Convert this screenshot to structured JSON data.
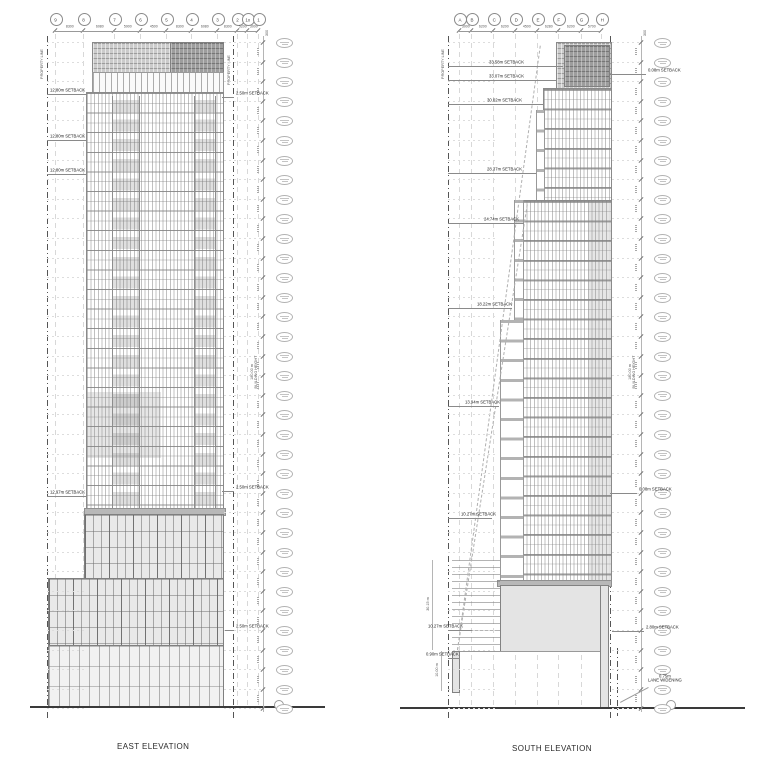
{
  "sheet": {
    "background": "#ffffff",
    "line_color": "#8a8a8a",
    "dark_panel_color": "#9d9d9d",
    "light_panel_color": "#cbcbcb"
  },
  "east": {
    "title": "EAST ELEVATION",
    "property_line_left": "PROPERTY LINE",
    "property_line_right": "PROPERTY LINE",
    "building_height_value": "180.00 m",
    "building_height_caption": "BUILDING HEIGHT",
    "top_margin_dim": "300",
    "level_column": {
      "count": 35
    },
    "grid_bubbles": [
      {
        "label": "9",
        "x": 55
      },
      {
        "label": "8",
        "x": 83
      },
      {
        "label": "7",
        "x": 114
      },
      {
        "label": "6",
        "x": 140
      },
      {
        "label": "5",
        "x": 166
      },
      {
        "label": "4",
        "x": 191
      },
      {
        "label": "3",
        "x": 217
      },
      {
        "label": "2",
        "x": 237
      },
      {
        "label": "1x",
        "x": 247
      },
      {
        "label": "1",
        "x": 258
      }
    ],
    "grid_dims": [
      "8300",
      "6080",
      "5900",
      "4500",
      "8300",
      "6080",
      "8300",
      "5200",
      "3000"
    ],
    "setbacks": [
      {
        "label": "12.80m SETBACK",
        "side": "left",
        "y": 90,
        "x1": 47,
        "x2": 86,
        "tx": 50
      },
      {
        "label": "12.80m SETBACK",
        "side": "left",
        "y": 136,
        "x1": 47,
        "x2": 86,
        "tx": 50
      },
      {
        "label": "12.80m SETBACK",
        "side": "left",
        "y": 170,
        "x1": 47,
        "x2": 86,
        "tx": 50
      },
      {
        "label": "12.97m SETBACK",
        "side": "left",
        "y": 492,
        "x1": 47,
        "x2": 86,
        "tx": 50
      },
      {
        "label": "2.50m SETBACK",
        "side": "right",
        "y": 93,
        "x1": 222,
        "x2": 234,
        "tx": 236
      },
      {
        "label": "2.50m SETBACK",
        "side": "right",
        "y": 487,
        "x1": 222,
        "x2": 234,
        "tx": 236
      },
      {
        "label": "2.50m SETBACK",
        "side": "right",
        "y": 626,
        "x1": 225,
        "x2": 234,
        "tx": 236
      }
    ]
  },
  "south": {
    "title": "SOUTH ELEVATION",
    "property_line_left": "PROPERTY LINE",
    "property_line_right": "PROPERTY LINE",
    "building_height_value": "180.00 m",
    "building_height_caption": "BUILDING HEIGHT",
    "top_margin_dim": "300",
    "dim_30": "30.15 m",
    "dim_10": "10.00 m",
    "lane_widening_value": "0.75m",
    "lane_widening_caption": "LANE WIDENING",
    "level_column": {
      "count": 35
    },
    "grid_bubbles": [
      {
        "label": "A",
        "x": 459
      },
      {
        "label": "B",
        "x": 471
      },
      {
        "label": "C",
        "x": 493
      },
      {
        "label": "D",
        "x": 515
      },
      {
        "label": "E",
        "x": 537
      },
      {
        "label": "F",
        "x": 558
      },
      {
        "label": "G",
        "x": 581
      },
      {
        "label": "H",
        "x": 601
      }
    ],
    "grid_dims": [
      "3000",
      "6200",
      "6200",
      "4500",
      "6280",
      "6200",
      "5700"
    ],
    "setbacks": [
      {
        "label": "33.58m SETBACK",
        "side": "left",
        "y": 62,
        "x1": 448,
        "x2": 563,
        "tx": 489
      },
      {
        "label": "33.07m SETBACK",
        "side": "left",
        "y": 76,
        "x1": 448,
        "x2": 557,
        "tx": 489
      },
      {
        "label": "30.02m SETBACK",
        "side": "left",
        "y": 100,
        "x1": 448,
        "x2": 543,
        "tx": 487
      },
      {
        "label": "28.37m SETBACK",
        "side": "left",
        "y": 169,
        "x1": 448,
        "x2": 536,
        "tx": 487
      },
      {
        "label": "24.74m SETBACK",
        "side": "left",
        "y": 219,
        "x1": 448,
        "x2": 524,
        "tx": 484
      },
      {
        "label": "18.22m SETBACK",
        "side": "left",
        "y": 304,
        "x1": 448,
        "x2": 512,
        "tx": 477
      },
      {
        "label": "13.94m SETBACK",
        "side": "left",
        "y": 402,
        "x1": 448,
        "x2": 499,
        "tx": 465
      },
      {
        "label": "10.27m SETBACK",
        "side": "left",
        "y": 514,
        "x1": 448,
        "x2": 492,
        "tx": 461
      },
      {
        "label": "10.27m SETBACK",
        "side": "left",
        "y": 626,
        "x1": 448,
        "x2": 472,
        "tx": 428
      },
      {
        "label": "0.90m SETBACK",
        "side": "left",
        "y": 654,
        "x1": 448,
        "x2": 460,
        "tx": 426
      },
      {
        "label": "0.08m SETBACK",
        "side": "right",
        "y": 70,
        "x1": 610,
        "x2": 646,
        "tx": 648
      },
      {
        "label": "0.08m SETBACK",
        "side": "right",
        "y": 489,
        "x1": 610,
        "x2": 637,
        "tx": 639
      },
      {
        "label": "2.80m SETBACK",
        "side": "right",
        "y": 627,
        "x1": 612,
        "x2": 644,
        "tx": 646
      }
    ]
  }
}
